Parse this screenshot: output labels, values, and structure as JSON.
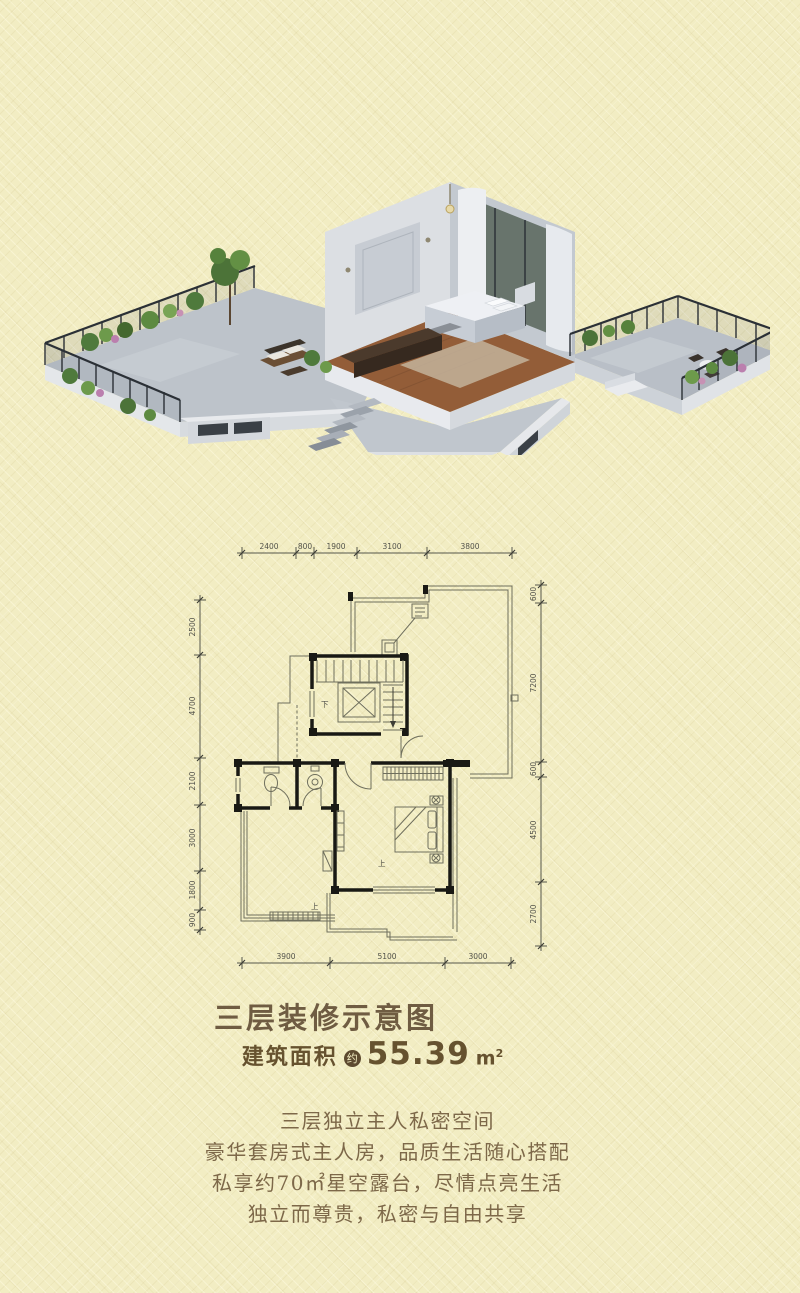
{
  "title": "三层装修示意图",
  "area": {
    "label": "建筑面积",
    "badge": "约",
    "value": "55.39",
    "unit": "m",
    "unit_sup": "2"
  },
  "description": [
    "三层独立主人私密空间",
    "豪华套房式主人房，品质生活随心搭配",
    "私享约70㎡星空露台，尽情点亮生活",
    "独立而尊贵，私密与自由共享"
  ],
  "floor_plan": {
    "dims_top": [
      "2400",
      "800",
      "1900",
      "3100",
      "3800"
    ],
    "dims_left": [
      "2500",
      "4700",
      "2100",
      "3000",
      "1800",
      "900"
    ],
    "dims_right": [
      "600",
      "7200",
      "600",
      "4500",
      "2700"
    ],
    "dims_bottom": [
      "3900",
      "5100",
      "3000"
    ],
    "stair_down": "下",
    "step_up": "上"
  },
  "colors": {
    "background": "#f2edc3",
    "heading": "#6f5c42",
    "body_text": "#7d6849",
    "badge_bg": "#5d4a2f",
    "plan_wall": "#191914",
    "plan_line": "#6f6f5d"
  }
}
